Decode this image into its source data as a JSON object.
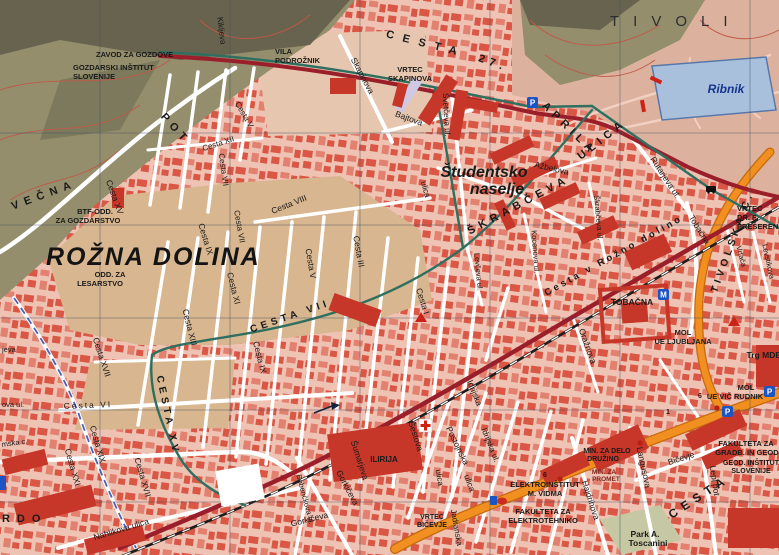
{
  "map_title": "Rožna dolina / Tivoli city map (Ljubljana)",
  "colors": {
    "bg": "#eec3b3",
    "b1": "#d95140",
    "b2": "#e27e6d",
    "bld": "#c6372a",
    "maroon": "#9b1f2b",
    "teal": "#2f6f60",
    "orange": "#f19020",
    "orange_dark": "#c56a0e",
    "rail": "#1d1d1d",
    "water": "#a9c0dc",
    "water_dark": "#5878aa",
    "forest": "#948e6c",
    "forest_dark": "#5f5c49",
    "field": "#d8b68f",
    "park": "#dcb29e",
    "grid": "#3e4e66",
    "contour": "#c05848",
    "label": "#1a1a1a",
    "label_blue": "#16368e",
    "path": "#f2cfc0"
  },
  "labels": [
    {
      "n": "tivoli-area",
      "t": "TIVOLI",
      "x": 610,
      "y": 26,
      "s": 15,
      "ls": 14,
      "w": 500,
      "a": "start",
      "f": "#2e2e2e"
    },
    {
      "n": "ribnik-pond",
      "t": "Ribnik",
      "x": 726,
      "y": 93,
      "s": 12,
      "w": 700,
      "i": true,
      "f": "#16368e"
    },
    {
      "n": "rozna-dolina-area",
      "t": "ROŽNA DOLINA",
      "x": 46,
      "y": 265,
      "s": 25,
      "ls": 2,
      "w": 700,
      "i": true,
      "a": "start",
      "f": "#141414"
    },
    {
      "n": "studentsko-naselje-1",
      "t": "Študentsko",
      "x": 484,
      "y": 177,
      "s": 16,
      "w": 700,
      "i": true
    },
    {
      "n": "studentsko-naselje-2",
      "t": "naselje",
      "x": 497,
      "y": 194,
      "s": 16,
      "w": 700,
      "i": true
    },
    {
      "n": "brdo-area",
      "t": "BRDO",
      "x": -13,
      "y": 522,
      "s": 11,
      "ls": 7,
      "w": 600,
      "a": "start"
    },
    {
      "n": "zavod-za-gozdove",
      "t": "ZAVOD ZA GOZDOVE",
      "x": 96,
      "y": 57,
      "s": 7.5,
      "w": 700,
      "a": "start"
    },
    {
      "n": "gozdarski-institut-1",
      "t": "GOZDARSKI INŠTITUT",
      "x": 73,
      "y": 70,
      "s": 7.5,
      "w": 700,
      "a": "start"
    },
    {
      "n": "gozdarski-institut-2",
      "t": "SLOVENIJE",
      "x": 73,
      "y": 79,
      "s": 7.5,
      "w": 700,
      "a": "start"
    },
    {
      "n": "vila-podroznik-1",
      "t": "VILA",
      "x": 275,
      "y": 54,
      "s": 7.5,
      "w": 700,
      "a": "start"
    },
    {
      "n": "vila-podroznik-2",
      "t": "PODROŽNIK",
      "x": 275,
      "y": 63,
      "s": 7.5,
      "w": 700,
      "a": "start"
    },
    {
      "n": "vrtec-skapinova-1",
      "t": "VRTEC",
      "x": 410,
      "y": 72,
      "s": 7.5,
      "w": 700
    },
    {
      "n": "vrtec-skapinova-2",
      "t": "SKAPINOVA",
      "x": 410,
      "y": 81,
      "s": 7.5,
      "w": 700
    },
    {
      "n": "btf-odd-1",
      "t": "BTF-ODD.",
      "x": 95,
      "y": 214,
      "s": 7.5,
      "w": 700
    },
    {
      "n": "btf-odd-2",
      "t": "ZA GOZDARSTVO",
      "x": 88,
      "y": 223,
      "s": 7.5,
      "w": 700
    },
    {
      "n": "odd-za-lesarstvo-1",
      "t": "ODD. ZA",
      "x": 110,
      "y": 277,
      "s": 7.5,
      "w": 700
    },
    {
      "n": "odd-za-lesarstvo-2",
      "t": "LESARSTVO",
      "x": 100,
      "y": 286,
      "s": 7.5,
      "w": 700
    },
    {
      "n": "vrtec-preseren-1",
      "t": "VRTEC",
      "x": 737,
      "y": 211,
      "s": 7.5,
      "w": 700,
      "a": "start"
    },
    {
      "n": "vrtec-preseren-2",
      "t": "DR. F.",
      "x": 737,
      "y": 220,
      "s": 7.5,
      "w": 700,
      "a": "start"
    },
    {
      "n": "vrtec-preseren-3",
      "t": "PREŠEREN",
      "x": 737,
      "y": 229,
      "s": 7.5,
      "w": 700,
      "a": "start"
    },
    {
      "n": "tobacna-poi",
      "t": "TOBAČNA",
      "x": 632,
      "y": 305,
      "s": 8.5,
      "w": 700
    },
    {
      "n": "mol-ljubljana-1",
      "t": "MOL",
      "x": 683,
      "y": 335,
      "s": 7.5,
      "w": 700
    },
    {
      "n": "mol-ljubljana-2",
      "t": "UE LJUBLJANA",
      "x": 683,
      "y": 344,
      "s": 7.5,
      "w": 700
    },
    {
      "n": "trg-mdb",
      "t": "Trg MDB",
      "x": 764,
      "y": 358,
      "s": 8.5,
      "w": 700
    },
    {
      "n": "mol-vic-1",
      "t": "MOL",
      "x": 746,
      "y": 390,
      "s": 7.5,
      "w": 700
    },
    {
      "n": "mol-vic-2",
      "t": "UE VIČ RUDNIK",
      "x": 735,
      "y": 399,
      "s": 7.5,
      "w": 700
    },
    {
      "n": "fak-gradb-1",
      "t": "FAKULTETA ZA",
      "x": 746,
      "y": 446,
      "s": 7.5,
      "w": 700
    },
    {
      "n": "fak-gradb-2",
      "t": "GRADB. IN GEOD.",
      "x": 748,
      "y": 455,
      "s": 7.5,
      "w": 700
    },
    {
      "n": "geod-institut-1",
      "t": "GEOD. INŠTITUT",
      "x": 751,
      "y": 465,
      "s": 7,
      "w": 700
    },
    {
      "n": "geod-institut-2",
      "t": "SLOVENIJE",
      "x": 751,
      "y": 473,
      "s": 7,
      "w": 700
    },
    {
      "n": "min-delo-1",
      "t": "MIN. ZA DELO",
      "x": 607,
      "y": 453,
      "s": 7,
      "w": 700
    },
    {
      "n": "min-delo-2",
      "t": "DRUŽINO",
      "x": 603,
      "y": 461,
      "s": 7,
      "w": 700
    },
    {
      "n": "min-promet-1",
      "t": "MIN. ZA",
      "x": 604,
      "y": 474,
      "s": 6.5,
      "w": 700,
      "f": "#7c241a"
    },
    {
      "n": "min-promet-2",
      "t": "PROMET",
      "x": 606,
      "y": 481,
      "s": 6.5,
      "w": 700,
      "f": "#7c241a"
    },
    {
      "n": "elektroinstitut-1",
      "t": "ELEKTROINŠTITUT",
      "x": 545,
      "y": 487,
      "s": 7.5,
      "w": 700
    },
    {
      "n": "elektroinstitut-2",
      "t": "M. VIDMA",
      "x": 545,
      "y": 496,
      "s": 7.5,
      "w": 700
    },
    {
      "n": "fak-elektro-1",
      "t": "FAKULTETA ZA",
      "x": 543,
      "y": 514,
      "s": 7.5,
      "w": 700
    },
    {
      "n": "fak-elektro-2",
      "t": "ELEKTROTEHNIKO",
      "x": 543,
      "y": 523,
      "s": 7.5,
      "w": 700
    },
    {
      "n": "park-toscanini-1",
      "t": "Park A.",
      "x": 645,
      "y": 537,
      "s": 8.5,
      "w": 700
    },
    {
      "n": "park-toscanini-2",
      "t": "Toscanini",
      "x": 648,
      "y": 546,
      "s": 8.5,
      "w": 700
    },
    {
      "n": "vrtec-bicevje-1",
      "t": "VRTEC",
      "x": 432,
      "y": 519,
      "s": 7,
      "w": 700
    },
    {
      "n": "vrtec-bicevje-2",
      "t": "BIČEVJE",
      "x": 432,
      "y": 527,
      "s": 7,
      "w": 700
    },
    {
      "n": "ilirija",
      "t": "ILIRIJA",
      "x": 384,
      "y": 462,
      "s": 8,
      "w": 700
    },
    {
      "n": "cesta-27-aprila-1",
      "t": "CESTA",
      "x": 425,
      "y": 47,
      "s": 11,
      "r": 14,
      "ls": 9,
      "w": 600
    },
    {
      "n": "cesta-27-aprila-2",
      "t": "27.",
      "x": 492,
      "y": 66,
      "s": 11,
      "r": 20,
      "ls": 5,
      "w": 600
    },
    {
      "n": "cesta-27-aprila-3",
      "t": "APRILA",
      "x": 567,
      "y": 131,
      "s": 11,
      "r": 44,
      "ls": 5,
      "w": 600
    },
    {
      "n": "vecna-pot-1",
      "t": "VEČNA",
      "x": 45,
      "y": 198,
      "s": 11,
      "r": -20,
      "ls": 6,
      "w": 600
    },
    {
      "n": "vecna-pot-2",
      "t": "POT",
      "x": 173,
      "y": 131,
      "s": 11,
      "r": 48,
      "ls": 5,
      "w": 600
    },
    {
      "n": "kikljeva",
      "t": "Kikljeva",
      "x": 219,
      "y": 31,
      "s": 8,
      "r": 83
    },
    {
      "n": "skapinova",
      "t": "Skapinova",
      "x": 360,
      "y": 77,
      "s": 8.5,
      "r": 62
    },
    {
      "n": "bajtova",
      "t": "Bajtova",
      "x": 408,
      "y": 121,
      "s": 8.5,
      "r": 20
    },
    {
      "n": "svetceva",
      "t": "Svetčeva ul.",
      "x": 444,
      "y": 115,
      "s": 8,
      "r": 87
    },
    {
      "n": "azbelova",
      "t": "Ažbelova",
      "x": 551,
      "y": 171,
      "s": 8.5,
      "r": 13
    },
    {
      "n": "rutarjeva",
      "t": "Rutarjeva ul.",
      "x": 663,
      "y": 179,
      "s": 8.5,
      "r": 57
    },
    {
      "n": "skrabceva-big",
      "t": "ŠKRABČEVA",
      "x": 520,
      "y": 208,
      "s": 11,
      "r": -28,
      "ls": 5,
      "w": 600
    },
    {
      "n": "skrabceva-ulica-big",
      "t": "ULICA",
      "x": 604,
      "y": 142,
      "s": 11,
      "r": -38,
      "ls": 5,
      "w": 600
    },
    {
      "n": "kocenova",
      "t": "Kocenova ul.",
      "x": 533,
      "y": 252,
      "s": 7.5,
      "r": 86
    },
    {
      "n": "skrabceva-small",
      "t": "Škrabčeva ul.",
      "x": 596,
      "y": 218,
      "s": 7.5,
      "r": 85
    },
    {
      "n": "levceva",
      "t": "Levčeva ul.",
      "x": 476,
      "y": 272,
      "s": 7.5,
      "r": 85
    },
    {
      "n": "ulica-studentsko",
      "t": "ulica",
      "x": 423,
      "y": 190,
      "s": 8,
      "r": 75
    },
    {
      "n": "cesta-v-rozno-dolino",
      "t": "Cesta v Rožno dolino",
      "x": 615,
      "y": 258,
      "s": 9.5,
      "r": -29,
      "ls": 3,
      "w": 600
    },
    {
      "n": "tobacna-street",
      "t": "Tobačna",
      "x": 697,
      "y": 231,
      "s": 8.5,
      "r": 58
    },
    {
      "n": "tivolska-cesta",
      "t": "TIVOLSKA C.",
      "x": 735,
      "y": 243,
      "s": 10,
      "r": -70,
      "ls": 4,
      "w": 600
    },
    {
      "n": "vrtaca",
      "t": "Vrtača",
      "x": 739,
      "y": 257,
      "s": 7.5,
      "r": 75
    },
    {
      "n": "levstikova",
      "t": "Levstikova",
      "x": 766,
      "y": 262,
      "s": 7.5,
      "r": 78
    },
    {
      "n": "cesta-xv-top",
      "t": "Cesta XV",
      "x": 112,
      "y": 198,
      "s": 8.5,
      "r": 70
    },
    {
      "n": "cesta-xii",
      "t": "Cesta XII",
      "x": 219,
      "y": 146,
      "s": 8,
      "r": -18
    },
    {
      "n": "cesta-vii-top",
      "t": "Cesta VII",
      "x": 221,
      "y": 170,
      "s": 8,
      "r": 82
    },
    {
      "n": "cesta-v-top",
      "t": "Cesta V",
      "x": 242,
      "y": 116,
      "s": 8,
      "r": 60
    },
    {
      "n": "cesta-xvii-upper",
      "t": "Cesta XVII",
      "x": 99,
      "y": 358,
      "s": 8.5,
      "r": 72
    },
    {
      "n": "cesta-xv-big",
      "t": "CESTA XV",
      "x": 165,
      "y": 416,
      "s": 10,
      "r": 78,
      "ls": 4,
      "w": 600
    },
    {
      "n": "cesta-xiii",
      "t": "Cesta XIII",
      "x": 187,
      "y": 328,
      "s": 8.5,
      "r": 76
    },
    {
      "n": "cesta-xi",
      "t": "Cesta XI",
      "x": 231,
      "y": 289,
      "s": 8.5,
      "r": 76
    },
    {
      "n": "cesta-ix",
      "t": "Cesta IX",
      "x": 203,
      "y": 240,
      "s": 8.5,
      "r": 73
    },
    {
      "n": "cesta-ix-2",
      "t": "Cesta IX",
      "x": 257,
      "y": 358,
      "s": 8.5,
      "r": 76
    },
    {
      "n": "cesta-vii-mid",
      "t": "Cesta VII",
      "x": 237,
      "y": 227,
      "s": 8,
      "r": 80
    },
    {
      "n": "cesta-viii",
      "t": "Cesta VIII",
      "x": 290,
      "y": 207,
      "s": 8.5,
      "r": -22
    },
    {
      "n": "cesta-v-mid",
      "t": "Cesta V",
      "x": 308,
      "y": 264,
      "s": 8.5,
      "r": 80
    },
    {
      "n": "cesta-iii",
      "t": "Cesta III",
      "x": 356,
      "y": 252,
      "s": 8.5,
      "r": 80
    },
    {
      "n": "cesta-i",
      "t": "Cesta I",
      "x": 420,
      "y": 302,
      "s": 8.5,
      "r": 72
    },
    {
      "n": "cesta-vii-big",
      "t": "CESTA VII",
      "x": 291,
      "y": 319,
      "s": 10,
      "r": -19,
      "ls": 4,
      "w": 600
    },
    {
      "n": "cesta-vi",
      "t": "Cesta VI",
      "x": 88,
      "y": 408,
      "s": 8.5,
      "r": -2,
      "ls": 2
    },
    {
      "n": "cesta-xix",
      "t": "Cesta XIX",
      "x": 95,
      "y": 445,
      "s": 8.5,
      "r": 74
    },
    {
      "n": "cesta-xxi",
      "t": "Cesta XXI",
      "x": 70,
      "y": 468,
      "s": 8.5,
      "r": 74
    },
    {
      "n": "cesta-xvii-lower",
      "t": "Cesta XVII",
      "x": 140,
      "y": 478,
      "s": 8.5,
      "r": 74
    },
    {
      "n": "nahlikova",
      "t": "Nahlikova ulica",
      "x": 122,
      "y": 532,
      "s": 8.5,
      "r": -17
    },
    {
      "n": "mska-c",
      "t": "mska c.",
      "x": 2,
      "y": 447,
      "s": 7.5,
      "r": -8,
      "a": "start"
    },
    {
      "n": "ova-ul",
      "t": "ova ul.",
      "x": 2,
      "y": 407,
      "s": 7.5,
      "a": "start"
    },
    {
      "n": "jeva",
      "t": "jeva",
      "x": 2,
      "y": 352,
      "s": 7.5,
      "a": "start"
    },
    {
      "n": "oraznova",
      "t": "Oražnova",
      "x": 585,
      "y": 347,
      "s": 8.5,
      "r": 70
    },
    {
      "n": "postojnska",
      "t": "Postojnska",
      "x": 455,
      "y": 447,
      "s": 8.5,
      "r": 64
    },
    {
      "n": "postojnska-ulica",
      "t": "ulica",
      "x": 467,
      "y": 484,
      "s": 8.5,
      "r": 70
    },
    {
      "n": "idrijska",
      "t": "Idrijska",
      "x": 472,
      "y": 394,
      "s": 8.5,
      "r": 68
    },
    {
      "n": "idrijska-ul",
      "t": "Idrijska ul.",
      "x": 488,
      "y": 446,
      "s": 8,
      "r": 68
    },
    {
      "n": "sestova",
      "t": "Šestova",
      "x": 413,
      "y": 437,
      "s": 8.5,
      "r": 72
    },
    {
      "n": "sestova-ulica",
      "t": "ulica",
      "x": 437,
      "y": 478,
      "s": 8,
      "r": 80
    },
    {
      "n": "jadranska",
      "t": "Jadranska",
      "x": 454,
      "y": 528,
      "s": 8,
      "r": 80
    },
    {
      "n": "sumarjeva",
      "t": "Šumarjeva",
      "x": 357,
      "y": 461,
      "s": 8.5,
      "r": 72
    },
    {
      "n": "gorkiceva-1",
      "t": "Gorkičeva",
      "x": 345,
      "y": 489,
      "s": 8.5,
      "r": 62
    },
    {
      "n": "gorkiceva-2",
      "t": "Gorkičeva",
      "x": 310,
      "y": 522,
      "s": 8.5,
      "r": -14
    },
    {
      "n": "bobenckova",
      "t": "Bobenčkova ul.",
      "x": 303,
      "y": 500,
      "s": 7.5,
      "r": 75
    },
    {
      "n": "hajdrihova",
      "t": "Hajdrihova",
      "x": 588,
      "y": 501,
      "s": 8.5,
      "r": 72
    },
    {
      "n": "langusova",
      "t": "Langusova",
      "x": 641,
      "y": 468,
      "s": 8.5,
      "r": 78
    },
    {
      "n": "bicevje",
      "t": "Bičevje",
      "x": 682,
      "y": 461,
      "s": 8.5,
      "r": -18
    },
    {
      "n": "lepi-pot",
      "t": "Lepi pot",
      "x": 712,
      "y": 481,
      "s": 8.5,
      "r": 82
    },
    {
      "n": "cesta-bottom-right",
      "t": "CESTA",
      "x": 701,
      "y": 500,
      "s": 12,
      "r": -33,
      "ls": 6,
      "w": 600
    },
    {
      "n": "route-1",
      "t": "1",
      "x": 668,
      "y": 414,
      "s": 7,
      "w": 700,
      "f": "#3c0d08"
    },
    {
      "n": "route-6",
      "t": "6",
      "x": 700,
      "y": 398,
      "s": 7,
      "w": 700,
      "f": "#3c0d08"
    },
    {
      "n": "route-6b",
      "t": "6",
      "x": 545,
      "y": 477,
      "s": 7,
      "w": 700,
      "f": "#3c0d08"
    }
  ],
  "icons": [
    {
      "type": "parking",
      "glyph": "P",
      "x": 527,
      "y": 97
    },
    {
      "type": "parking",
      "glyph": "P",
      "x": 722,
      "y": 406
    },
    {
      "type": "parking",
      "glyph": "P",
      "x": 764,
      "y": 386
    },
    {
      "type": "museum",
      "glyph": "M",
      "x": 658,
      "y": 289
    },
    {
      "type": "bus-stop",
      "x": 706,
      "y": 186
    },
    {
      "type": "landmark-triangle",
      "x": 421,
      "y": 318
    },
    {
      "type": "landmark-triangle",
      "x": 734,
      "y": 322
    },
    {
      "type": "first-aid",
      "x": 419,
      "y": 419
    },
    {
      "type": "fuel-station",
      "x": 494,
      "y": 500
    },
    {
      "type": "blue-marker",
      "x": -2,
      "y": 476
    },
    {
      "type": "route-dot",
      "x": 560,
      "y": 479
    },
    {
      "type": "route-dot",
      "x": 640,
      "y": 443
    },
    {
      "type": "route-dot",
      "x": 717,
      "y": 408
    },
    {
      "type": "one-way-arrow",
      "x": 324,
      "y": 407
    },
    {
      "type": "red-bar",
      "x": 656,
      "y": 80,
      "rot": 25
    },
    {
      "type": "red-bar",
      "x": 643,
      "y": 106,
      "rot": 80
    }
  ]
}
